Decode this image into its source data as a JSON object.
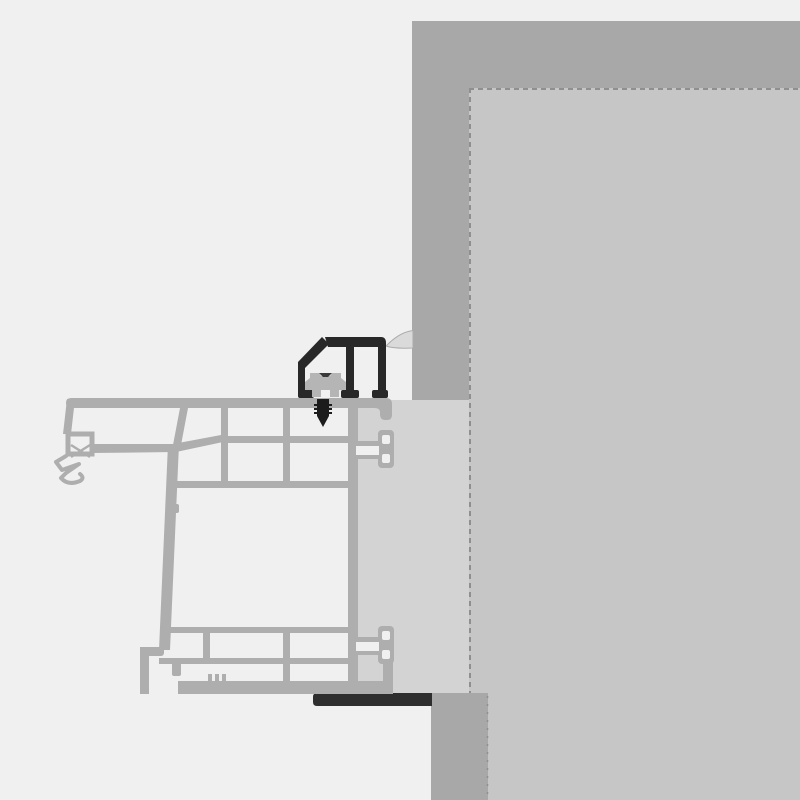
{
  "canvas": {
    "width": 800,
    "height": 800
  },
  "colors": {
    "background": "#f0f0f0",
    "wall_outer": "#a8a8a8",
    "wall_inner_panel": "#c6c6c6",
    "panel_border": "#8f8f8f",
    "frame_extension_strip": "#d3d3d3",
    "membrane": "#dadada",
    "membrane_edge": "#ababab",
    "joint_seal": "#2e2e2e",
    "profile": "#aeaeae",
    "profile_cavity": "#f0f0f0",
    "bracket": "#282828",
    "bracket_cavity": "#f0f0f0",
    "clip": "#b5b5b5",
    "clip_slot": "#3a3a3a",
    "screw": "#1c1c1c"
  },
  "components": {
    "wall_outer_layer": "outer-wall-layer",
    "wall_inner_panel": "inner-wall-panel",
    "frame_extension_strip": "frame-extension-strip",
    "lower_wall_column": "lower-wall-column",
    "sealing_membrane": "sealing-membrane",
    "bottom_joint_seal": "bottom-joint-seal",
    "window_frame_profile": "window-frame-profile",
    "glazing_gasket": "gasket-x-symbol",
    "mounting_bracket": "mounting-bracket",
    "mounting_clip": "mounting-clip",
    "fastening_screw": "fastening-screw"
  }
}
